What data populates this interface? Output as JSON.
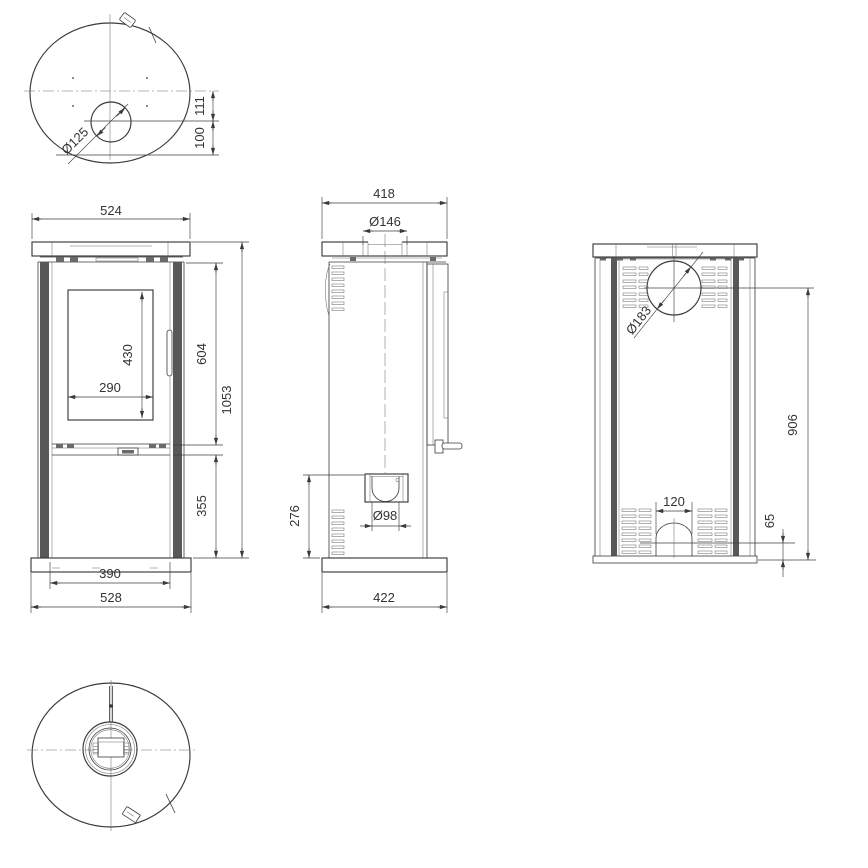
{
  "drawing": {
    "type": "technical-dimension-drawing",
    "subject": "free-standing oval stove, five orthographic views",
    "colors": {
      "line": "#3a3a3a",
      "detail_line": "#6f6f6f",
      "dark_panel": "#585858",
      "text": "#333333",
      "background": "#ffffff"
    },
    "views": {
      "top": {
        "dims": {
          "flue_diameter": "Ø125",
          "flue_to_center": "111",
          "flue_to_edge": "100"
        }
      },
      "front": {
        "dims": {
          "top_width": "524",
          "glass_height": "430",
          "glass_width": "290",
          "upper_height": "604",
          "total_height": "1053",
          "lower_height": "355",
          "body_width": "390",
          "base_width": "528"
        }
      },
      "side": {
        "dims": {
          "top_depth": "418",
          "collar_diameter": "Ø146",
          "inlet_diameter": "Ø98",
          "inlet_height": "276",
          "base_depth": "422"
        }
      },
      "back": {
        "dims": {
          "outlet_diameter": "Ø183",
          "outlet_height": "906",
          "opening_width": "120",
          "opening_height": "65"
        }
      },
      "bottom": {
        "dims": {}
      }
    }
  }
}
